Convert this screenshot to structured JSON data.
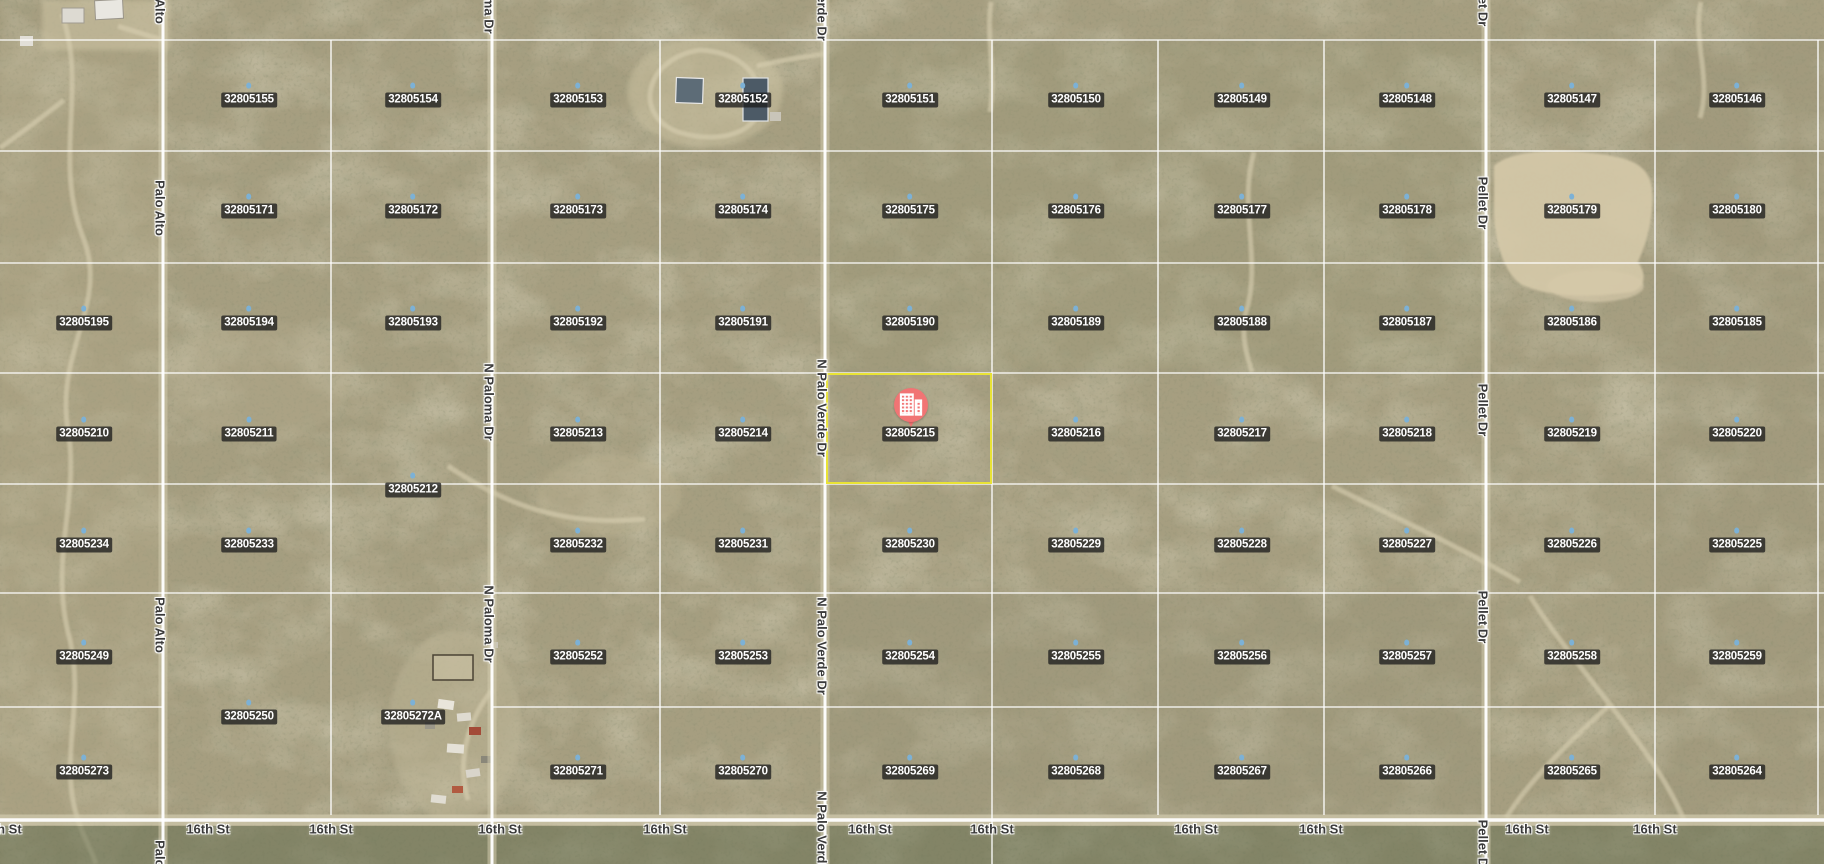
{
  "map": {
    "width": 1824,
    "height": 864,
    "imagery": "desert-satellite",
    "colors": {
      "terrain_base": "#a69e80",
      "grid_line": "rgba(255,255,255,0.82)",
      "road_line": "rgba(255,255,255,0.95)",
      "road_bed": "#d2cbae",
      "parcel_label_bg": "rgba(30,30,30,0.78)",
      "parcel_label_text": "#ffffff",
      "street_label_text": "#3a3a3a",
      "highlight_outline": "#e9e335",
      "marker_fill": "#f17474",
      "parcel_dot": "#7cb1d6",
      "vegetation_strip": "#5f6a4b",
      "clearing": "#d5c9a9"
    }
  },
  "parcels": [
    {
      "apn": "32805155",
      "x": 249,
      "y": 100
    },
    {
      "apn": "32805154",
      "x": 413,
      "y": 100
    },
    {
      "apn": "32805153",
      "x": 578,
      "y": 100
    },
    {
      "apn": "32805152",
      "x": 743,
      "y": 100
    },
    {
      "apn": "32805151",
      "x": 910,
      "y": 100
    },
    {
      "apn": "32805150",
      "x": 1076,
      "y": 100
    },
    {
      "apn": "32805149",
      "x": 1242,
      "y": 100
    },
    {
      "apn": "32805148",
      "x": 1407,
      "y": 100
    },
    {
      "apn": "32805147",
      "x": 1572,
      "y": 100
    },
    {
      "apn": "32805146",
      "x": 1737,
      "y": 100
    },
    {
      "apn": "32805171",
      "x": 249,
      "y": 211
    },
    {
      "apn": "32805172",
      "x": 413,
      "y": 211
    },
    {
      "apn": "32805173",
      "x": 578,
      "y": 211
    },
    {
      "apn": "32805174",
      "x": 743,
      "y": 211
    },
    {
      "apn": "32805175",
      "x": 910,
      "y": 211
    },
    {
      "apn": "32805176",
      "x": 1076,
      "y": 211
    },
    {
      "apn": "32805177",
      "x": 1242,
      "y": 211
    },
    {
      "apn": "32805178",
      "x": 1407,
      "y": 211
    },
    {
      "apn": "32805179",
      "x": 1572,
      "y": 211
    },
    {
      "apn": "32805180",
      "x": 1737,
      "y": 211
    },
    {
      "apn": "32805195",
      "x": 84,
      "y": 323
    },
    {
      "apn": "32805194",
      "x": 249,
      "y": 323
    },
    {
      "apn": "32805193",
      "x": 413,
      "y": 323
    },
    {
      "apn": "32805192",
      "x": 578,
      "y": 323
    },
    {
      "apn": "32805191",
      "x": 743,
      "y": 323
    },
    {
      "apn": "32805190",
      "x": 910,
      "y": 323
    },
    {
      "apn": "32805189",
      "x": 1076,
      "y": 323
    },
    {
      "apn": "32805188",
      "x": 1242,
      "y": 323
    },
    {
      "apn": "32805187",
      "x": 1407,
      "y": 323
    },
    {
      "apn": "32805186",
      "x": 1572,
      "y": 323
    },
    {
      "apn": "32805185",
      "x": 1737,
      "y": 323
    },
    {
      "apn": "32805210",
      "x": 84,
      "y": 434
    },
    {
      "apn": "32805211",
      "x": 249,
      "y": 434
    },
    {
      "apn": "32805212",
      "x": 413,
      "y": 490
    },
    {
      "apn": "32805213",
      "x": 578,
      "y": 434
    },
    {
      "apn": "32805214",
      "x": 743,
      "y": 434
    },
    {
      "apn": "32805215",
      "x": 910,
      "y": 434
    },
    {
      "apn": "32805216",
      "x": 1076,
      "y": 434
    },
    {
      "apn": "32805217",
      "x": 1242,
      "y": 434
    },
    {
      "apn": "32805218",
      "x": 1407,
      "y": 434
    },
    {
      "apn": "32805219",
      "x": 1572,
      "y": 434
    },
    {
      "apn": "32805220",
      "x": 1737,
      "y": 434
    },
    {
      "apn": "32805234",
      "x": 84,
      "y": 545
    },
    {
      "apn": "32805233",
      "x": 249,
      "y": 545
    },
    {
      "apn": "32805232",
      "x": 578,
      "y": 545
    },
    {
      "apn": "32805231",
      "x": 743,
      "y": 545
    },
    {
      "apn": "32805230",
      "x": 910,
      "y": 545
    },
    {
      "apn": "32805229",
      "x": 1076,
      "y": 545
    },
    {
      "apn": "32805228",
      "x": 1242,
      "y": 545
    },
    {
      "apn": "32805227",
      "x": 1407,
      "y": 545
    },
    {
      "apn": "32805226",
      "x": 1572,
      "y": 545
    },
    {
      "apn": "32805225",
      "x": 1737,
      "y": 545
    },
    {
      "apn": "32805249",
      "x": 84,
      "y": 657
    },
    {
      "apn": "32805252",
      "x": 578,
      "y": 657
    },
    {
      "apn": "32805253",
      "x": 743,
      "y": 657
    },
    {
      "apn": "32805254",
      "x": 910,
      "y": 657
    },
    {
      "apn": "32805255",
      "x": 1076,
      "y": 657
    },
    {
      "apn": "32805256",
      "x": 1242,
      "y": 657
    },
    {
      "apn": "32805257",
      "x": 1407,
      "y": 657
    },
    {
      "apn": "32805258",
      "x": 1572,
      "y": 657
    },
    {
      "apn": "32805259",
      "x": 1737,
      "y": 657
    },
    {
      "apn": "32805250",
      "x": 249,
      "y": 717
    },
    {
      "apn": "32805272A",
      "x": 413,
      "y": 717
    },
    {
      "apn": "32805273",
      "x": 84,
      "y": 772
    },
    {
      "apn": "32805271",
      "x": 578,
      "y": 772
    },
    {
      "apn": "32805270",
      "x": 743,
      "y": 772
    },
    {
      "apn": "32805269",
      "x": 910,
      "y": 772
    },
    {
      "apn": "32805268",
      "x": 1076,
      "y": 772
    },
    {
      "apn": "32805267",
      "x": 1242,
      "y": 772
    },
    {
      "apn": "32805266",
      "x": 1407,
      "y": 772
    },
    {
      "apn": "32805265",
      "x": 1572,
      "y": 772
    },
    {
      "apn": "32805264",
      "x": 1737,
      "y": 772
    }
  ],
  "highlighted_parcel": {
    "apn": "32805215",
    "x": 826,
    "y": 373,
    "width": 166,
    "height": 111,
    "marker": {
      "x": 911,
      "y": 428,
      "icon": "building-icon"
    }
  },
  "streets": {
    "vertical": [
      {
        "name": "Palo Alto",
        "x": 160,
        "label_ys": [
          -4,
          208,
          625,
          868
        ]
      },
      {
        "name": "N Paloma Dr",
        "x": 489,
        "label_ys": [
          -5,
          402,
          624
        ]
      },
      {
        "name": "N Palo Verde Dr",
        "x": 822,
        "label_ys": [
          -8,
          408,
          646,
          840
        ]
      },
      {
        "name": "Pellet Dr",
        "x": 1483,
        "label_ys": [
          0,
          203,
          410,
          617,
          846
        ]
      }
    ],
    "horizontal": [
      {
        "name": "16th St",
        "y": 829,
        "label_xs": [
          0,
          208,
          331,
          500,
          665,
          870,
          992,
          1196,
          1321,
          1527,
          1655
        ]
      }
    ]
  },
  "grid": {
    "h_lines": [
      {
        "y": 40,
        "x1": 0,
        "x2": 1824
      },
      {
        "y": 151,
        "x1": 0,
        "x2": 1824
      },
      {
        "y": 263,
        "x1": 0,
        "x2": 1824
      },
      {
        "y": 373,
        "x1": 0,
        "x2": 1824
      },
      {
        "y": 484,
        "x1": 0,
        "x2": 1824
      },
      {
        "y": 593,
        "x1": 0,
        "x2": 1824
      },
      {
        "y": 707,
        "x1": 0,
        "x2": 163
      },
      {
        "y": 707,
        "x1": 493,
        "x2": 1824
      }
    ],
    "v_lines": [
      {
        "x": 331,
        "y1": 40,
        "y2": 815
      },
      {
        "x": 660,
        "y1": 40,
        "y2": 815
      },
      {
        "x": 992,
        "y1": 40,
        "y2": 864
      },
      {
        "x": 1158,
        "y1": 40,
        "y2": 815
      },
      {
        "x": 1324,
        "y1": 40,
        "y2": 815
      },
      {
        "x": 1655,
        "y1": 40,
        "y2": 815
      },
      {
        "x": 1818,
        "y1": 40,
        "y2": 815
      }
    ],
    "roads_vertical": [
      {
        "name": "Palo Alto",
        "x": 163
      },
      {
        "name": "N Paloma Dr",
        "x": 492
      },
      {
        "name": "N Palo Verde Dr",
        "x": 825
      },
      {
        "name": "Pellet Dr",
        "x": 1486
      }
    ],
    "road_horizontal": {
      "name": "16th St",
      "y": 820
    }
  }
}
